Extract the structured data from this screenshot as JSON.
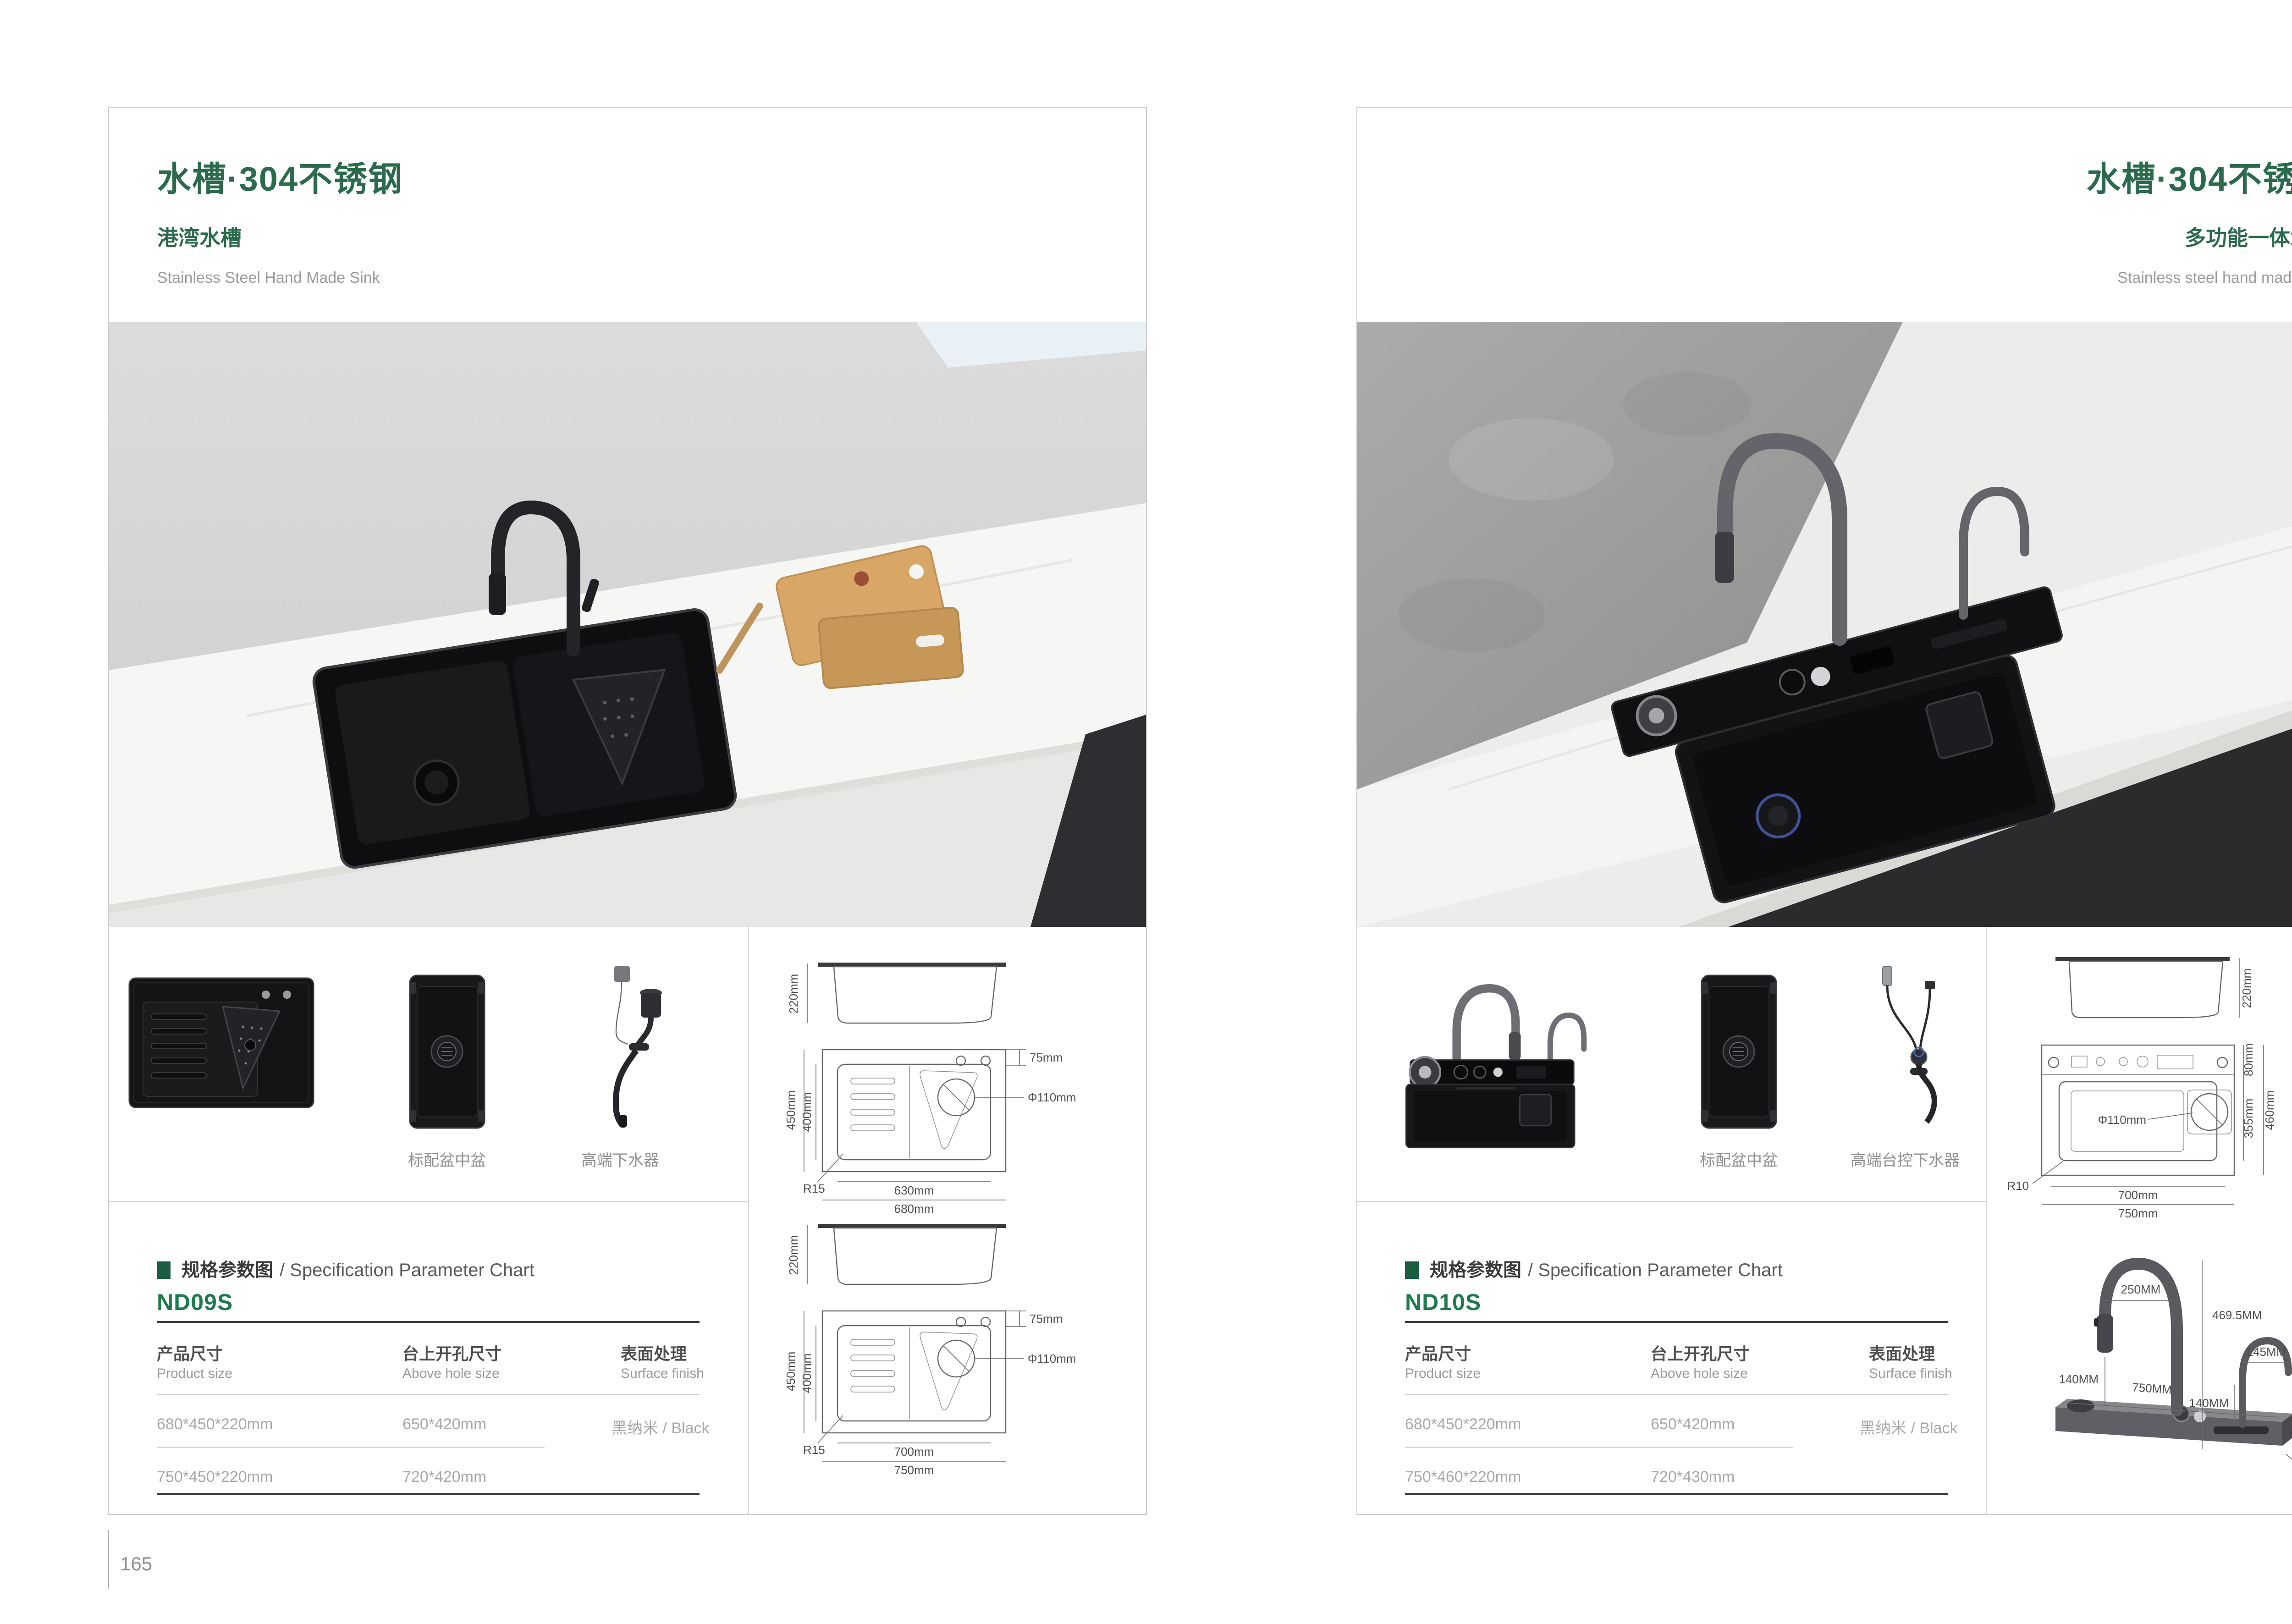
{
  "accent_color": "#2b6a4c",
  "model_color": "#1f7a4e",
  "pages": {
    "left": {
      "page_number": "165",
      "header": {
        "title": "水槽·304不锈钢",
        "subtitle": "港湾水槽",
        "subtitle_en": "Stainless Steel Hand Made Sink"
      },
      "thumbnails": {
        "basin_label": "标配盆中盆",
        "drain_label": "高端下水器"
      },
      "spec": {
        "section_title_cn": "规格参数图",
        "section_title_en": "/ Specification Parameter Chart",
        "model": "ND09S",
        "columns": [
          {
            "cn": "产品尺寸",
            "en": "Product size"
          },
          {
            "cn": "台上开孔尺寸",
            "en": "Above hole size"
          },
          {
            "cn": "表面处理",
            "en": "Surface finish"
          }
        ],
        "rows": [
          [
            "680*450*220mm",
            "650*420mm",
            "黑纳米 / Black"
          ],
          [
            "750*450*220mm",
            "720*420mm",
            ""
          ]
        ]
      },
      "drawings": {
        "side1": {
          "height": "220mm"
        },
        "top1": {
          "outer_h": "450mm",
          "inner_h": "400mm",
          "ledge": "75mm",
          "drain": "Φ110mm",
          "radius": "R15",
          "inner_w": "630mm",
          "outer_w": "680mm"
        },
        "side2": {
          "height": "220mm"
        },
        "top2": {
          "outer_h": "450mm",
          "inner_h": "400mm",
          "ledge": "75mm",
          "drain": "Φ110mm",
          "radius": "R15",
          "inner_w": "700mm",
          "outer_w": "750mm"
        }
      }
    },
    "right": {
      "page_number": "166",
      "header": {
        "title": "水槽·304不锈钢",
        "subtitle": "多功能一体水槽",
        "subtitle_en": "Stainless steel hand made sink"
      },
      "thumbnails": {
        "basin_label": "标配盆中盆",
        "drain_label": "高端台控下水器"
      },
      "spec": {
        "section_title_cn": "规格参数图",
        "section_title_en": "/ Specification Parameter Chart",
        "model": "ND10S",
        "columns": [
          {
            "cn": "产品尺寸",
            "en": "Product size"
          },
          {
            "cn": "台上开孔尺寸",
            "en": "Above hole size"
          },
          {
            "cn": "表面处理",
            "en": "Surface finish"
          }
        ],
        "rows": [
          [
            "680*450*220mm",
            "650*420mm",
            "黑纳米 / Black"
          ],
          [
            "750*460*220mm",
            "720*430mm",
            ""
          ]
        ]
      },
      "drawings": {
        "side": {
          "height": "220mm"
        },
        "top": {
          "deck": "80mm",
          "bowl_h": "355mm",
          "outer_h": "460mm",
          "drain": "Φ110mm",
          "radius": "R10",
          "inner_w": "700mm",
          "outer_w": "750mm"
        },
        "faucet": {
          "arc_w": "250MM",
          "total_h": "469.5MM",
          "head_h": "140MM",
          "base_w": "750MM",
          "arc2_w": "145MM",
          "head2_h": "140MM",
          "arc2_h": "225MM",
          "base_h": "40MM",
          "base_d": "80MM"
        }
      }
    }
  }
}
